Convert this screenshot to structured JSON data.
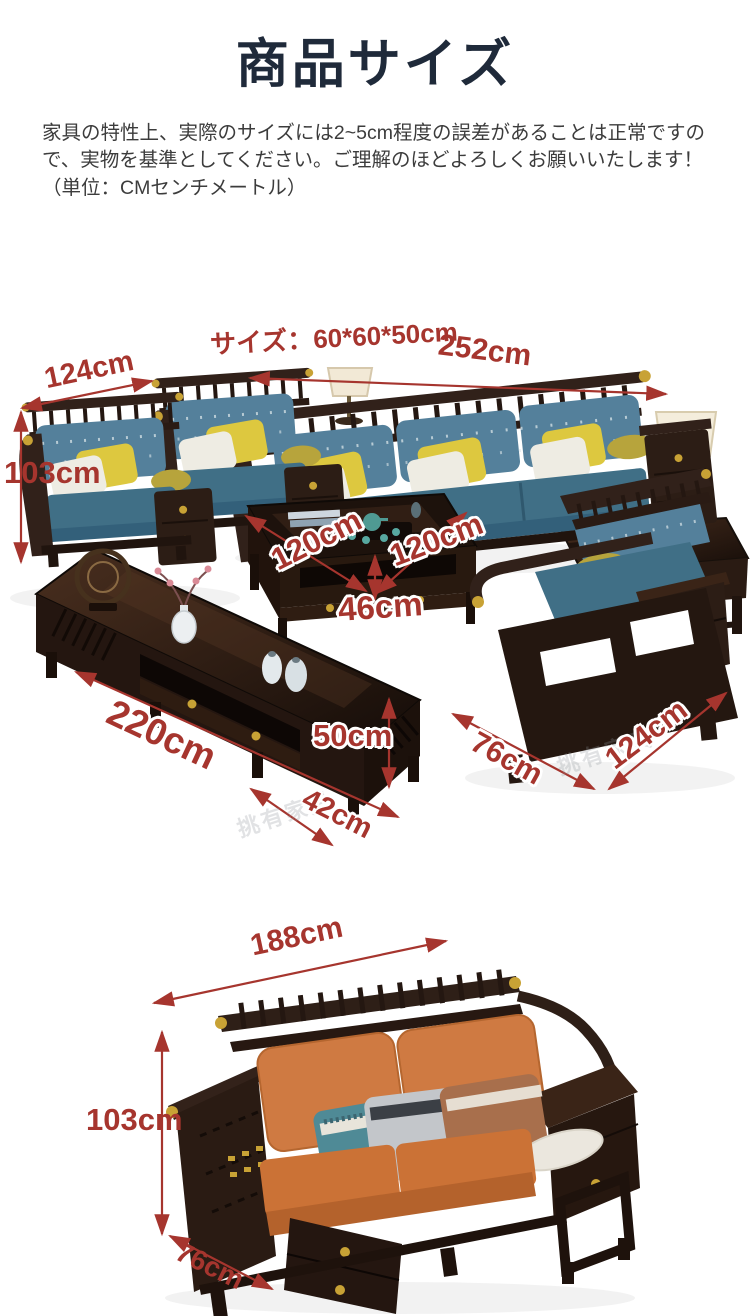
{
  "header": {
    "title": "商品サイズ"
  },
  "notice": {
    "text": "家具の特性上、実際のサイズには2~5cm程度の誤差があることは正常ですので、実物を基準としてください。ご理解のほどよろしくお願いいたします！（単位：CMセンチメートル）"
  },
  "colors": {
    "accent_red": "#a6352e",
    "title_navy": "#1f2a3a",
    "wood_dark": "#2a1b13",
    "cushion_blue": "#54809b",
    "cushion_orange": "#cf7a42",
    "pillow_yellow": "#ddc83f",
    "gold": "#c8a235"
  },
  "scene1": {
    "labels": {
      "side_table_size": "サイズ：60*60*50cm",
      "sofa_width": "252cm",
      "single_sofa_width": "124cm",
      "sofa_height": "103cm",
      "table_depth": "120cm",
      "table_width": "120cm",
      "table_height": "46cm",
      "tv_board_length": "220cm",
      "tv_board_height": "50cm",
      "tv_board_depth": "42cm",
      "armchair_depth": "76cm",
      "armchair_width": "124cm"
    },
    "watermark": "挑有家具"
  },
  "scene2": {
    "labels": {
      "sofa_width": "188cm",
      "sofa_height": "103cm",
      "sofa_depth": "76cm"
    }
  }
}
